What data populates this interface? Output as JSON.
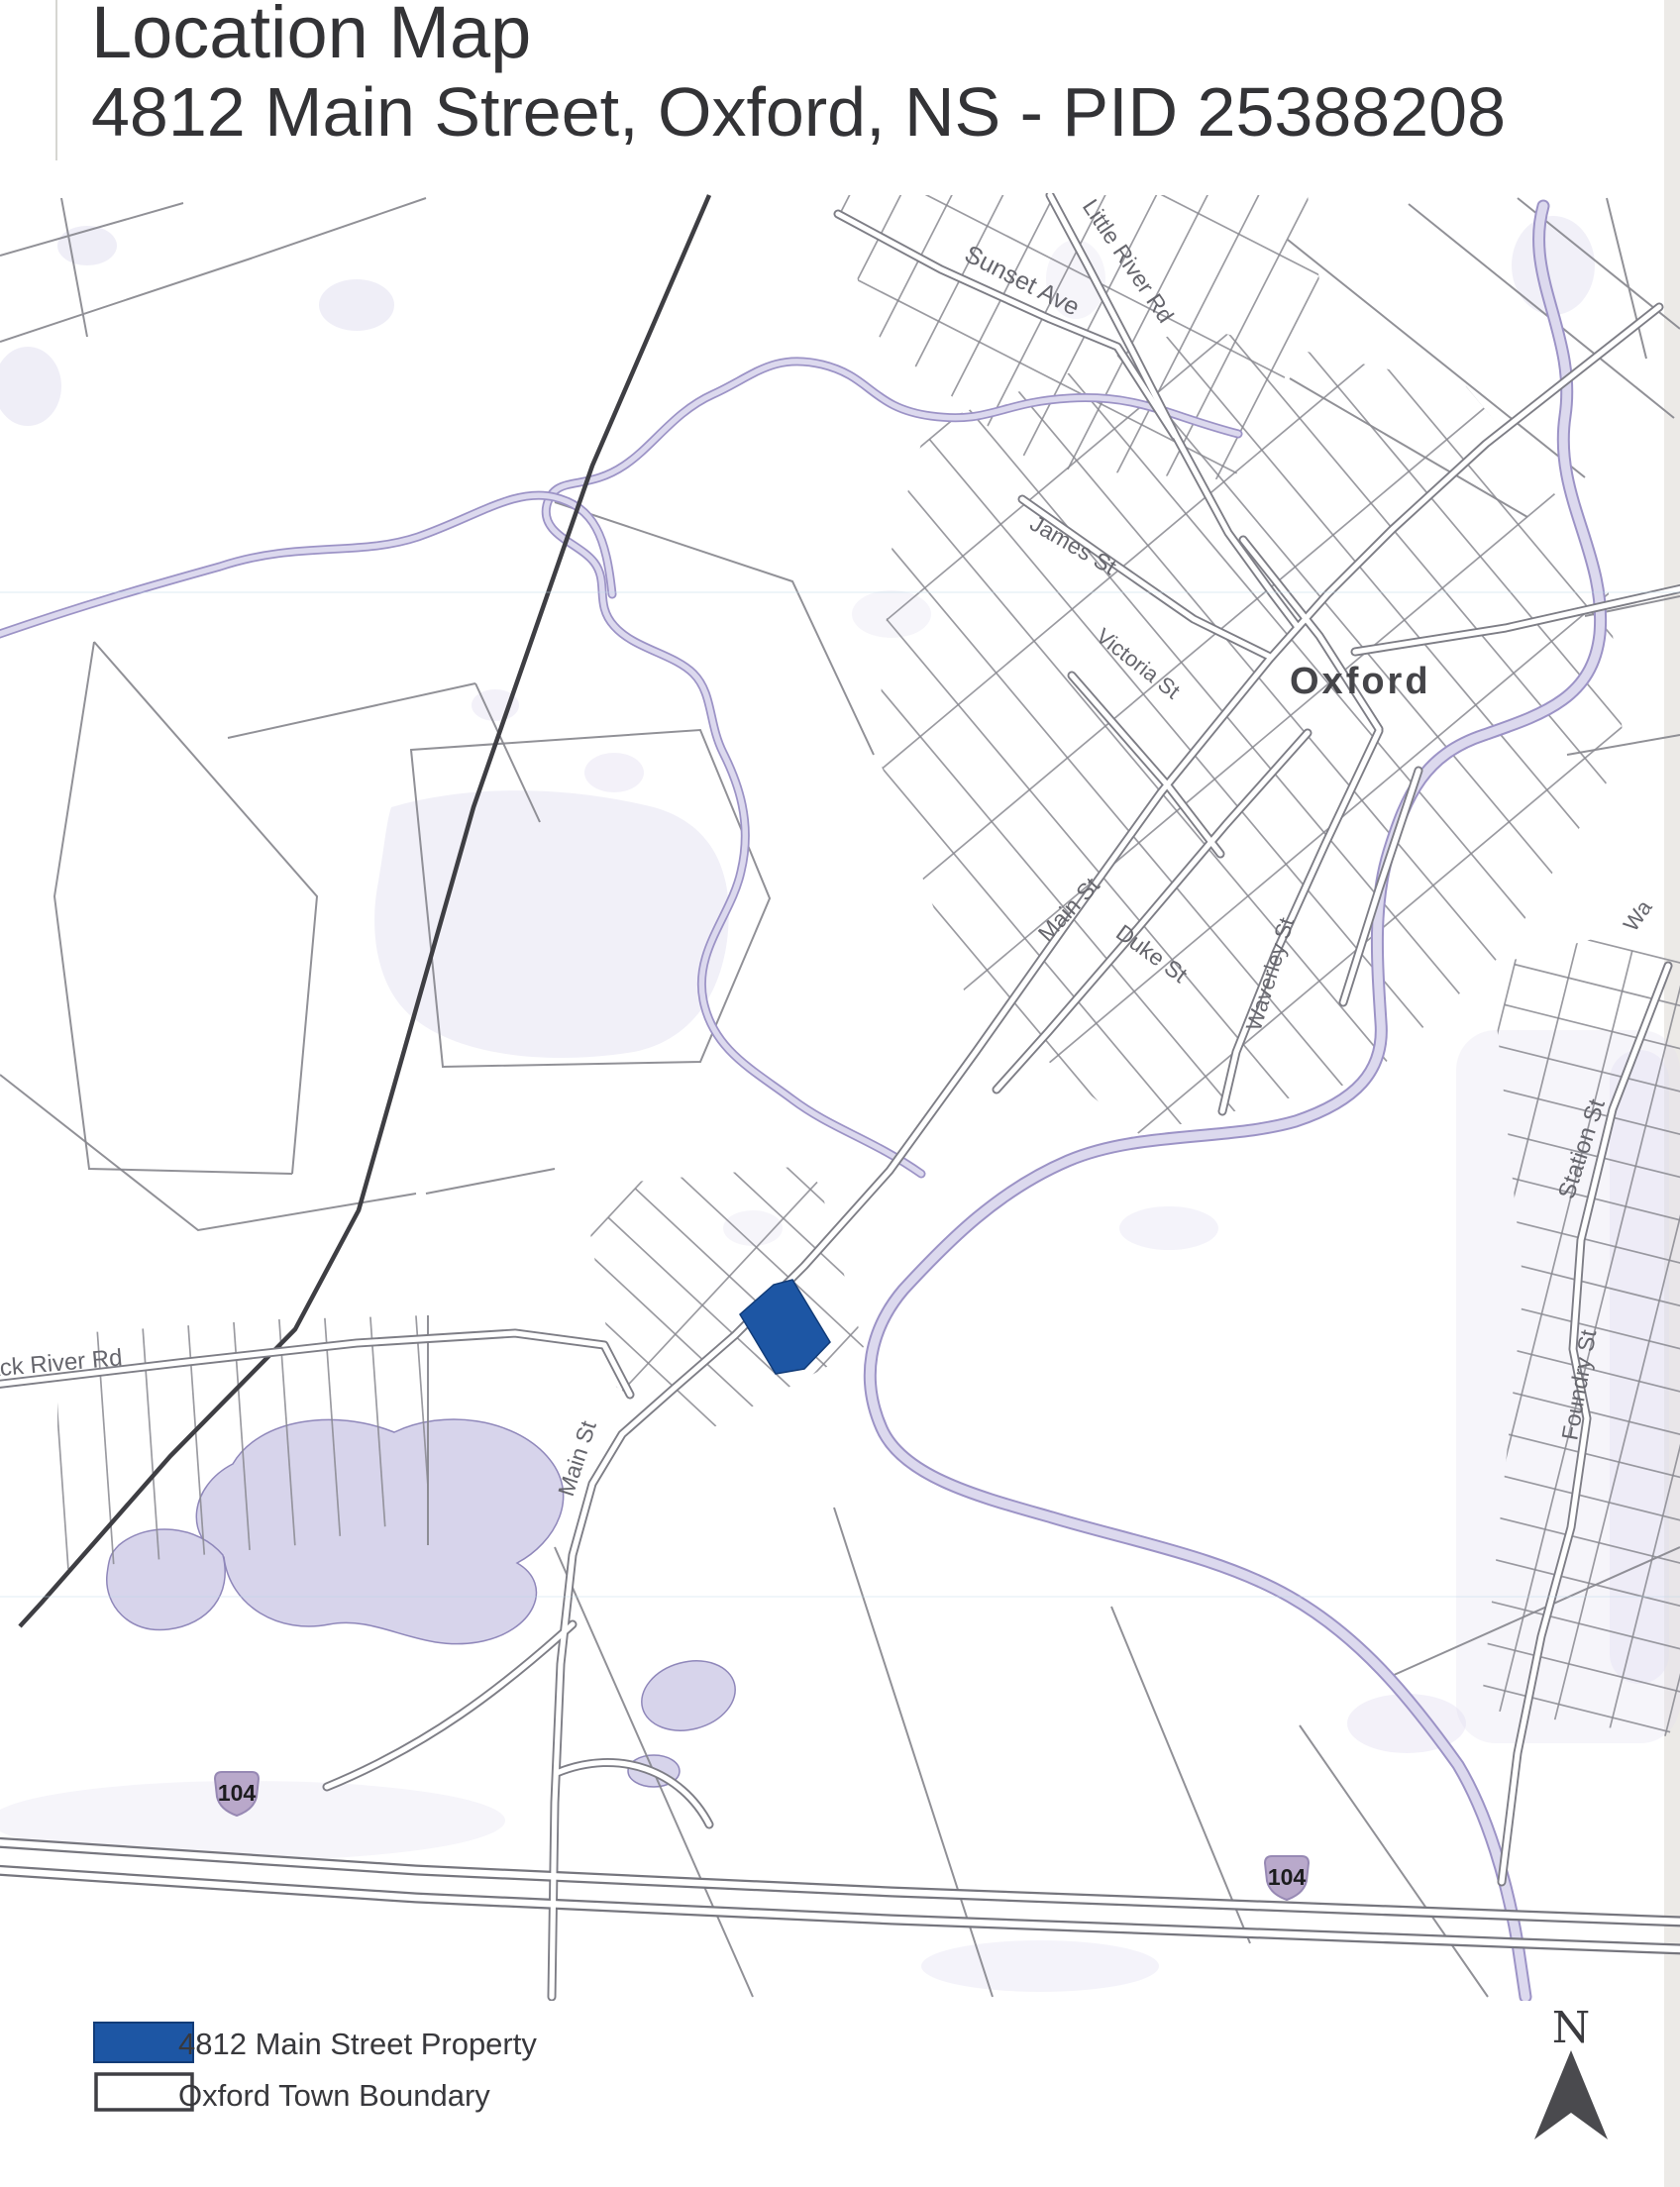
{
  "page": {
    "title_line1": "Location Map",
    "title_line2": "4812 Main Street, Oxford, NS - PID 25388208"
  },
  "map": {
    "town_label": "Oxford",
    "labels": {
      "sunset_ave": "Sunset Ave",
      "little_river_rd": "Little River Rd",
      "james_st": "James St",
      "victoria_st": "Victoria St",
      "main_st_upper": "Main St",
      "duke_st": "Duke St",
      "waverley_st": "Waverley St",
      "station_st": "Station St",
      "foundry_st": "Foundry St",
      "black_river_rd": "Black River Rd",
      "main_st_lower": "Main St",
      "water_st_partial": "Wa"
    },
    "highway_shields": [
      {
        "number": "104"
      },
      {
        "number": "104"
      }
    ],
    "north_label": "N",
    "colors": {
      "property_blue": "#1d56a4",
      "water_lavender": "#dcd9ee",
      "boundary_dark": "#3e3e43",
      "road_gray": "#7e7e86"
    }
  },
  "legend": {
    "items": [
      {
        "label": "4812 Main Street Property",
        "swatch": "blue-fill"
      },
      {
        "label": "Oxford Town Boundary",
        "swatch": "white-outline"
      }
    ]
  }
}
